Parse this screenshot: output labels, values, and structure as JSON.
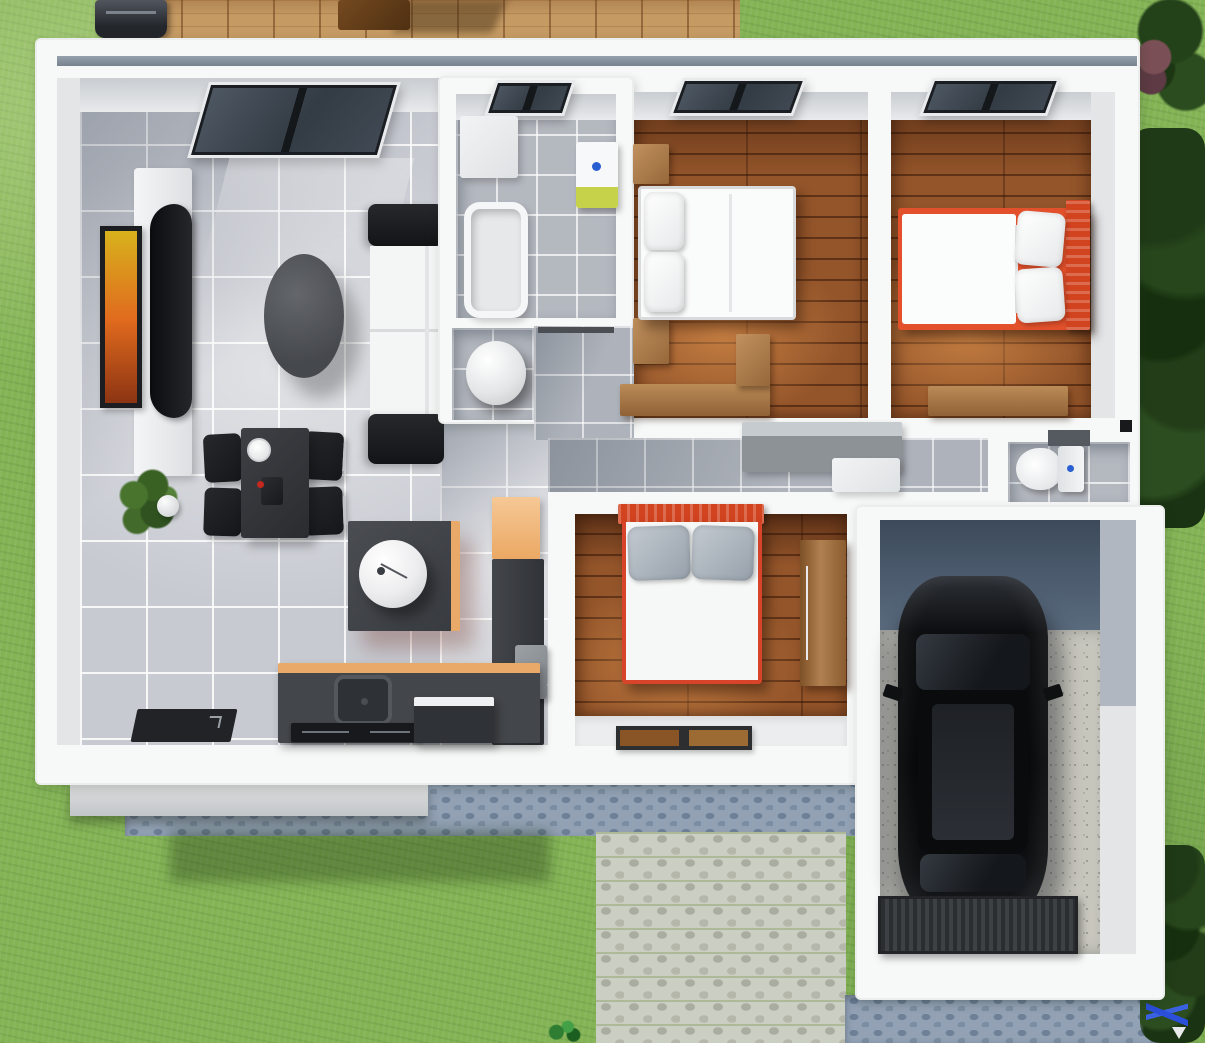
{
  "title": "3d-house-floor-plan-render",
  "palette": {
    "grass": "#83b355",
    "deck_wood": "#c59a63",
    "wall_white": "#f7f8f8",
    "tile_gray": "#c7cad1",
    "bedroom_wood": "#94552a",
    "accent_orange_bed": "#e2512c",
    "kitchen_counter_top": "#e9a968",
    "furniture_dark": "#2a2c30",
    "cobble_blue": "#92a1b4",
    "cobble_light": "#cbcec2",
    "car_black": "#0d0e10",
    "bath_sink_green": "#c6d34a",
    "faucet_blue": "#2a5fd1",
    "tree_green": "#1f3a17"
  },
  "rooms": [
    {
      "name": "living-room"
    },
    {
      "name": "dining-area"
    },
    {
      "name": "kitchen"
    },
    {
      "name": "bathroom"
    },
    {
      "name": "laundry-nook"
    },
    {
      "name": "hallway"
    },
    {
      "name": "bedroom-1"
    },
    {
      "name": "bedroom-2"
    },
    {
      "name": "bedroom-3"
    },
    {
      "name": "toilet-room"
    },
    {
      "name": "garage"
    },
    {
      "name": "deck"
    },
    {
      "name": "driveway"
    },
    {
      "name": "garden"
    }
  ],
  "scene": {
    "width": 1205,
    "height": 1043,
    "items": [
      {
        "name": "deck",
        "cls": "deck",
        "x": 135,
        "y": 0,
        "w": 605,
        "h": 40
      },
      {
        "name": "deck-table-shadow",
        "cls": "deck-shadow",
        "x": 400,
        "y": 0,
        "w": 100,
        "h": 33
      },
      {
        "name": "deck-table",
        "cls": "wood-table",
        "x": 338,
        "y": 0,
        "w": 72,
        "h": 30
      },
      {
        "name": "bbq-grill",
        "cls": "grill",
        "x": 95,
        "y": 0,
        "w": 72,
        "h": 38
      },
      {
        "name": "tree-top-right",
        "cls": "tree",
        "x": 1128,
        "y": 0,
        "w": 77,
        "h": 125
      },
      {
        "name": "bush-red",
        "cls": "bush-red",
        "x": 1136,
        "y": 36,
        "w": 36,
        "h": 60
      },
      {
        "name": "trees-right",
        "cls": "tree-dense",
        "x": 1130,
        "y": 128,
        "w": 75,
        "h": 400
      },
      {
        "name": "cobble-strip-blue",
        "cls": "cobble-blue",
        "x": 125,
        "y": 778,
        "w": 752,
        "h": 58
      },
      {
        "name": "porch-step",
        "cls": "step",
        "x": 70,
        "y": 782,
        "w": 358,
        "h": 34
      },
      {
        "name": "house-shadow-on-grass",
        "cls": "shadow-grass",
        "x": 170,
        "y": 830,
        "w": 380,
        "h": 52
      },
      {
        "name": "driveway-light-cobbles",
        "cls": "cobble-light",
        "x": 596,
        "y": 832,
        "w": 250,
        "h": 211
      },
      {
        "name": "cobble-below-garage",
        "cls": "cobble-blue",
        "x": 845,
        "y": 995,
        "w": 320,
        "h": 48
      },
      {
        "name": "trees-bottom-right",
        "cls": "tree-dense",
        "x": 1140,
        "y": 845,
        "w": 65,
        "h": 198
      },
      {
        "name": "sprout-plant-bottom",
        "cls": "sprout",
        "x": 545,
        "y": 1016,
        "w": 38,
        "h": 27
      },
      {
        "name": "garden-tool-blue",
        "cls": "blue-tool",
        "x": 1146,
        "y": 980,
        "w": 42,
        "h": 63
      },
      {
        "name": "house-body",
        "cls": "house",
        "x": 35,
        "y": 38,
        "w": 1105,
        "h": 747
      },
      {
        "name": "garage-body",
        "cls": "house",
        "x": 855,
        "y": 505,
        "w": 310,
        "h": 495
      },
      {
        "name": "roof-gutter",
        "cls": "gutter",
        "x": 57,
        "y": 56,
        "w": 1080,
        "h": 10
      },
      {
        "name": "left-wall-face",
        "cls": "wallface",
        "x": 57,
        "y": 78,
        "w": 23,
        "h": 667
      },
      {
        "name": "living-room-floor",
        "cls": "tile-living",
        "x": 80,
        "y": 78,
        "w": 360,
        "h": 667
      },
      {
        "name": "living-top-wall-face",
        "cls": "wallface-top",
        "x": 80,
        "y": 78,
        "w": 360,
        "h": 34
      },
      {
        "name": "kitchen-floor",
        "cls": "tile-living",
        "x": 440,
        "y": 420,
        "w": 108,
        "h": 325
      },
      {
        "name": "living-window",
        "cls": "window-big",
        "x": 198,
        "y": 82,
        "w": 192,
        "h": 76,
        "tf": "skewX(-16deg)"
      },
      {
        "name": "window-light-patch",
        "cls": "light-patch",
        "x": 215,
        "y": 158,
        "w": 185,
        "h": 115,
        "tf": "skewX(-14deg)"
      },
      {
        "name": "tv-stand",
        "cls": "tv-stand",
        "x": 134,
        "y": 168,
        "w": 58,
        "h": 308
      },
      {
        "name": "tv-screen",
        "cls": "tv",
        "x": 150,
        "y": 204,
        "w": 42,
        "h": 214
      },
      {
        "name": "wall-picture",
        "cls": "picture",
        "x": 100,
        "y": 226,
        "w": 42,
        "h": 182
      },
      {
        "name": "coffee-table",
        "cls": "coffee-table",
        "x": 264,
        "y": 254,
        "w": 80,
        "h": 124
      },
      {
        "name": "sofa-armrest-top",
        "cls": "sofa-dark",
        "x": 368,
        "y": 204,
        "w": 76,
        "h": 42
      },
      {
        "name": "sofa-seat",
        "cls": "sofa-seat",
        "x": 370,
        "y": 246,
        "w": 72,
        "h": 170
      },
      {
        "name": "sofa-armrest-bottom",
        "cls": "sofa-dark",
        "x": 368,
        "y": 414,
        "w": 76,
        "h": 50
      },
      {
        "name": "potted-plant",
        "cls": "plant",
        "x": 112,
        "y": 464,
        "w": 78,
        "h": 82
      },
      {
        "name": "dining-chair",
        "cls": "chair",
        "x": 204,
        "y": 434,
        "w": 38,
        "h": 48,
        "tf": "rotate(-3deg)"
      },
      {
        "name": "dining-chair",
        "cls": "chair",
        "x": 204,
        "y": 488,
        "w": 38,
        "h": 48,
        "tf": "rotate(2deg)"
      },
      {
        "name": "dining-chair",
        "cls": "chair",
        "x": 303,
        "y": 432,
        "w": 40,
        "h": 48,
        "tf": "rotate(3deg)"
      },
      {
        "name": "dining-chair",
        "cls": "chair",
        "x": 303,
        "y": 487,
        "w": 40,
        "h": 48,
        "tf": "rotate(-2deg)"
      },
      {
        "name": "dining-table",
        "cls": "table-dark",
        "x": 241,
        "y": 428,
        "w": 68,
        "h": 110
      },
      {
        "name": "plate",
        "cls": "plate",
        "x": 247,
        "y": 438,
        "w": 24,
        "h": 24
      },
      {
        "name": "table-centerpiece",
        "cls": "pepper",
        "x": 261,
        "y": 477,
        "w": 22,
        "h": 28
      },
      {
        "name": "kitchen-island",
        "cls": "island",
        "x": 348,
        "y": 521,
        "w": 112,
        "h": 110
      },
      {
        "name": "island-basin",
        "cls": "basin",
        "x": 359,
        "y": 540,
        "w": 68,
        "h": 68
      },
      {
        "name": "tall-cabinet-orange",
        "cls": "cab-orange",
        "x": 492,
        "y": 497,
        "w": 48,
        "h": 62
      },
      {
        "name": "tall-unit-dark",
        "cls": "unit-dark",
        "x": 492,
        "y": 559,
        "w": 52,
        "h": 186
      },
      {
        "name": "wall-appliance-gray",
        "cls": "graybox",
        "x": 515,
        "y": 645,
        "w": 32,
        "h": 54
      },
      {
        "name": "kitchen-counter",
        "cls": "counter",
        "x": 278,
        "y": 663,
        "w": 262,
        "h": 80
      },
      {
        "name": "kitchen-sink",
        "cls": "sink",
        "x": 334,
        "y": 675,
        "w": 58,
        "h": 50
      },
      {
        "name": "cooktop",
        "cls": "cooktop",
        "x": 291,
        "y": 723,
        "w": 132,
        "h": 19
      },
      {
        "name": "dishwasher",
        "cls": "appliance",
        "x": 414,
        "y": 697,
        "w": 80,
        "h": 46
      },
      {
        "name": "entry-doormat",
        "cls": "mat-dark",
        "x": 134,
        "y": 709,
        "w": 100,
        "h": 33,
        "tf": "skewX(-12deg)"
      },
      {
        "name": "bathroom-wall-block",
        "cls": "house",
        "x": 438,
        "y": 76,
        "w": 196,
        "h": 348
      },
      {
        "name": "bathroom-floor",
        "cls": "tile-bath",
        "x": 456,
        "y": 94,
        "w": 160,
        "h": 224
      },
      {
        "name": "bathroom-top-wall-face",
        "cls": "wallface-top",
        "x": 456,
        "y": 94,
        "w": 160,
        "h": 26
      },
      {
        "name": "bathroom-window",
        "cls": "window-small",
        "x": 490,
        "y": 80,
        "w": 80,
        "h": 36,
        "tf": "skewX(-18deg)"
      },
      {
        "name": "bathroom-cabinet",
        "cls": "white-block",
        "x": 460,
        "y": 116,
        "w": 58,
        "h": 62
      },
      {
        "name": "bathtub",
        "cls": "bathtub",
        "x": 464,
        "y": 202,
        "w": 64,
        "h": 116
      },
      {
        "name": "bathroom-sink",
        "cls": "bath-sink",
        "x": 576,
        "y": 142,
        "w": 42,
        "h": 66
      },
      {
        "name": "laundry-floor",
        "cls": "tile-bath",
        "x": 452,
        "y": 328,
        "w": 82,
        "h": 92
      },
      {
        "name": "water-heater",
        "cls": "heater",
        "x": 466,
        "y": 341,
        "w": 60,
        "h": 64
      },
      {
        "name": "hall-floor",
        "cls": "tile-hall",
        "x": 534,
        "y": 326,
        "w": 100,
        "h": 114
      },
      {
        "name": "hall-door",
        "cls": "door-line",
        "x": 538,
        "y": 327,
        "w": 76,
        "h": 6
      },
      {
        "name": "bedroom1-floor",
        "cls": "wood-floor",
        "x": 634,
        "y": 92,
        "w": 234,
        "h": 326
      },
      {
        "name": "bedroom1-top-wall-face",
        "cls": "wallface-top",
        "x": 634,
        "y": 92,
        "w": 234,
        "h": 28
      },
      {
        "name": "bedroom1-window",
        "cls": "window-small",
        "x": 676,
        "y": 78,
        "w": 124,
        "h": 38,
        "tf": "skewX(-20deg)"
      },
      {
        "name": "nightstand",
        "cls": "wood-block",
        "x": 633,
        "y": 144,
        "w": 36,
        "h": 40
      },
      {
        "name": "nightstand",
        "cls": "wood-block",
        "x": 633,
        "y": 318,
        "w": 36,
        "h": 46
      },
      {
        "name": "bed1",
        "cls": "bed-white",
        "x": 638,
        "y": 186,
        "w": 158,
        "h": 134
      },
      {
        "name": "bed1-pillow",
        "cls": "pillow",
        "x": 644,
        "y": 192,
        "w": 40,
        "h": 58
      },
      {
        "name": "bed1-pillow",
        "cls": "pillow",
        "x": 644,
        "y": 252,
        "w": 40,
        "h": 60
      },
      {
        "name": "bedroom1-desk",
        "cls": "wood-desk",
        "x": 620,
        "y": 384,
        "w": 150,
        "h": 32
      },
      {
        "name": "bedroom1-desk-return",
        "cls": "wood-block",
        "x": 736,
        "y": 334,
        "w": 34,
        "h": 52
      },
      {
        "name": "bedroom2-floor",
        "cls": "wood-floor",
        "x": 891,
        "y": 92,
        "w": 200,
        "h": 326
      },
      {
        "name": "bedroom2-right-wall-face",
        "cls": "wallface",
        "x": 1091,
        "y": 92,
        "w": 24,
        "h": 326
      },
      {
        "name": "bedroom2-top-wall-face",
        "cls": "wallface-top",
        "x": 891,
        "y": 92,
        "w": 200,
        "h": 28
      },
      {
        "name": "bedroom2-window",
        "cls": "window-small",
        "x": 926,
        "y": 78,
        "w": 128,
        "h": 38,
        "tf": "skewX(-20deg)"
      },
      {
        "name": "bed2-frame",
        "cls": "bed-frame-orange",
        "x": 898,
        "y": 208,
        "w": 192,
        "h": 122
      },
      {
        "name": "bed2-headboard",
        "cls": "headboard-red",
        "x": 1066,
        "y": 200,
        "w": 24,
        "h": 130
      },
      {
        "name": "bed2-mattress",
        "cls": "mattress",
        "x": 902,
        "y": 214,
        "w": 114,
        "h": 110
      },
      {
        "name": "bed2-pillow",
        "cls": "pillow",
        "x": 1016,
        "y": 212,
        "w": 48,
        "h": 54,
        "tf": "rotate(5deg)"
      },
      {
        "name": "bed2-pillow",
        "cls": "pillow",
        "x": 1016,
        "y": 268,
        "w": 48,
        "h": 54,
        "tf": "rotate(-4deg)"
      },
      {
        "name": "bedroom2-desk",
        "cls": "wood-desk",
        "x": 928,
        "y": 386,
        "w": 140,
        "h": 30
      },
      {
        "name": "corridor-floor",
        "cls": "tile-hall",
        "x": 548,
        "y": 438,
        "w": 440,
        "h": 54
      },
      {
        "name": "corridor-cabinet",
        "cls": "cab-gray",
        "x": 742,
        "y": 422,
        "w": 160,
        "h": 50
      },
      {
        "name": "corridor-chest",
        "cls": "white-block",
        "x": 832,
        "y": 458,
        "w": 68,
        "h": 34
      },
      {
        "name": "toilet-room-floor",
        "cls": "tile-bath",
        "x": 1008,
        "y": 442,
        "w": 122,
        "h": 60
      },
      {
        "name": "toilet-shelf",
        "cls": "unit-dark-sm",
        "x": 1048,
        "y": 430,
        "w": 42,
        "h": 16
      },
      {
        "name": "toilet-bowl",
        "cls": "toilet-bowl",
        "x": 1016,
        "y": 448,
        "w": 46,
        "h": 42
      },
      {
        "name": "toilet-tank",
        "cls": "toilet-tank",
        "x": 1058,
        "y": 446,
        "w": 26,
        "h": 46
      },
      {
        "name": "light-switch",
        "cls": "switch-dark",
        "x": 1120,
        "y": 420,
        "w": 12,
        "h": 12
      },
      {
        "name": "bedroom3-floor",
        "cls": "wood-floor",
        "x": 575,
        "y": 514,
        "w": 272,
        "h": 202
      },
      {
        "name": "bedroom3-entry-floor",
        "cls": "floor-white",
        "x": 575,
        "y": 716,
        "w": 272,
        "h": 30
      },
      {
        "name": "bedroom3-doormat",
        "cls": "mat-brown",
        "x": 616,
        "y": 726,
        "w": 136,
        "h": 24
      },
      {
        "name": "bed3-headboard",
        "cls": "headboard-red vert",
        "x": 618,
        "y": 504,
        "w": 146,
        "h": 20
      },
      {
        "name": "bed3-body",
        "cls": "bed3-body",
        "x": 622,
        "y": 522,
        "w": 140,
        "h": 162
      },
      {
        "name": "bed3-pillow",
        "cls": "pillow-gray",
        "x": 628,
        "y": 526,
        "w": 62,
        "h": 54,
        "tf": "rotate(-2deg)"
      },
      {
        "name": "bed3-pillow",
        "cls": "pillow-gray",
        "x": 692,
        "y": 526,
        "w": 62,
        "h": 54,
        "tf": "rotate(2deg)"
      },
      {
        "name": "bedroom3-wardrobe",
        "cls": "wood-tall",
        "x": 800,
        "y": 540,
        "w": 46,
        "h": 146
      },
      {
        "name": "garage-floor-shadowed",
        "cls": "g-dark",
        "x": 880,
        "y": 520,
        "w": 220,
        "h": 110
      },
      {
        "name": "garage-floor-gravel",
        "cls": "gravel",
        "x": 880,
        "y": 630,
        "w": 220,
        "h": 324
      },
      {
        "name": "garage-right-wall-face-top",
        "cls": "wallface-dk",
        "x": 1100,
        "y": 520,
        "w": 36,
        "h": 186
      },
      {
        "name": "garage-right-wall-face-bottom",
        "cls": "wallface",
        "x": 1100,
        "y": 706,
        "w": 36,
        "h": 248
      },
      {
        "name": "car-shadow",
        "cls": "shadow-car",
        "x": 890,
        "y": 600,
        "w": 174,
        "h": 332
      },
      {
        "name": "car-body",
        "cls": "car-body",
        "x": 898,
        "y": 576,
        "w": 150,
        "h": 350
      },
      {
        "name": "car-windshield",
        "cls": "car-glass",
        "x": 916,
        "y": 634,
        "w": 114,
        "h": 56
      },
      {
        "name": "car-roof",
        "cls": "car-roofpanel",
        "x": 918,
        "y": 690,
        "w": 110,
        "h": 164
      },
      {
        "name": "car-sunroof",
        "cls": "car-glass2",
        "x": 930,
        "y": 702,
        "w": 86,
        "h": 140
      },
      {
        "name": "car-rear-window",
        "cls": "car-glass",
        "x": 920,
        "y": 854,
        "w": 106,
        "h": 38
      },
      {
        "name": "car-mirror-left",
        "cls": "mirror",
        "x": 884,
        "y": 686,
        "w": 18,
        "h": 13,
        "tf": "rotate(18deg)"
      },
      {
        "name": "car-mirror-right",
        "cls": "mirror",
        "x": 1044,
        "y": 686,
        "w": 18,
        "h": 13,
        "tf": "rotate(-18deg)"
      },
      {
        "name": "garage-ribbed-mat",
        "cls": "rib-mat",
        "x": 878,
        "y": 896,
        "w": 200,
        "h": 58
      }
    ]
  }
}
